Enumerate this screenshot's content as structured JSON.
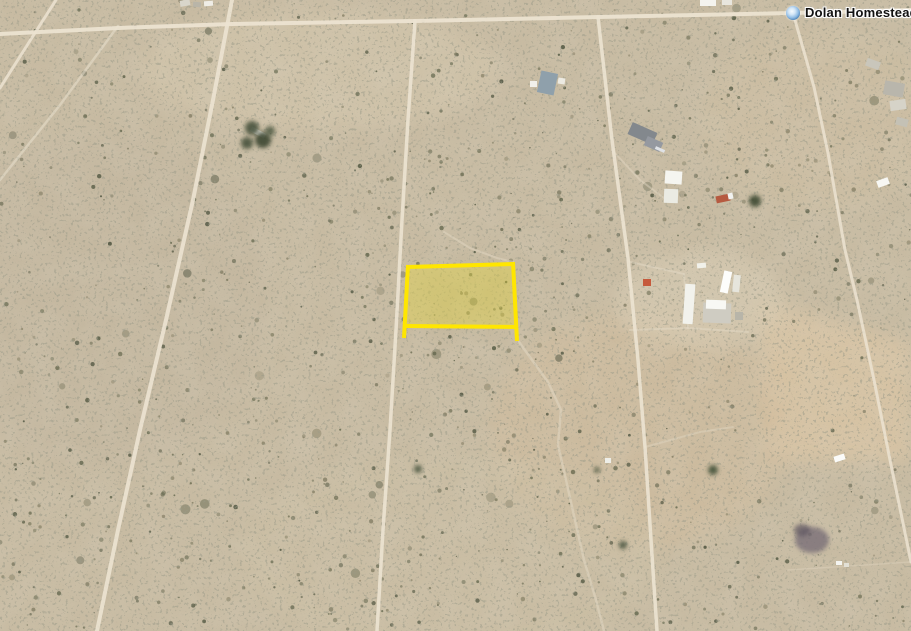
{
  "map": {
    "view": {
      "width": 911,
      "height": 631
    },
    "placemark": {
      "label": "Dolan Homestead",
      "x": 793,
      "y": 13
    },
    "colors": {
      "sand_base": "#c9bca3",
      "road": "#ece3d1",
      "trail": "#e4dac6",
      "parcel_stroke": "#ffe600",
      "parcel_fill": "#efdc35"
    },
    "parcel": {
      "name": "highlighted-parcel",
      "fill_polygon": [
        [
          408,
          266
        ],
        [
          514,
          263
        ],
        [
          517,
          326
        ],
        [
          406,
          325
        ]
      ],
      "fill_opacity": 0.35,
      "stroke_width": 4,
      "edges": [
        {
          "name": "parcel-edge-left",
          "points": [
            [
              408,
              265
            ],
            [
              404,
              338
            ]
          ]
        },
        {
          "name": "parcel-edge-right",
          "points": [
            [
              513,
              262
            ],
            [
              517,
              341
            ]
          ]
        },
        {
          "name": "parcel-edge-top",
          "points": [
            [
              407,
              267
            ],
            [
              514,
              264
            ]
          ]
        },
        {
          "name": "parcel-edge-bottom",
          "points": [
            [
              405,
              326
            ],
            [
              517,
              327
            ]
          ]
        }
      ]
    },
    "roads": [
      {
        "name": "top-road",
        "width": 4,
        "opacity": 0.95,
        "points": [
          [
            0,
            34
          ],
          [
            118,
            28
          ],
          [
            232,
            24
          ],
          [
            415,
            21
          ],
          [
            598,
            17
          ],
          [
            793,
            13
          ],
          [
            911,
            10
          ]
        ]
      },
      {
        "name": "long-diagonal-road",
        "width": 4,
        "opacity": 0.9,
        "points": [
          [
            232,
            0
          ],
          [
            213,
            100
          ],
          [
            193,
            200
          ],
          [
            166,
            320
          ],
          [
            140,
            430
          ],
          [
            118,
            530
          ],
          [
            97,
            631
          ]
        ]
      },
      {
        "name": "left-short-road",
        "width": 3,
        "opacity": 0.85,
        "points": [
          [
            56,
            0
          ],
          [
            40,
            25
          ],
          [
            0,
            88
          ]
        ]
      },
      {
        "name": "left-faint-trail",
        "width": 2.5,
        "opacity": 0.5,
        "points": [
          [
            118,
            26
          ],
          [
            60,
            105
          ],
          [
            0,
            180
          ]
        ]
      },
      {
        "name": "center-road",
        "width": 3.5,
        "opacity": 0.9,
        "points": [
          [
            415,
            21
          ],
          [
            408,
            120
          ],
          [
            402,
            220
          ],
          [
            396,
            330
          ],
          [
            390,
            430
          ],
          [
            383,
            530
          ],
          [
            377,
            631
          ]
        ]
      },
      {
        "name": "right-center-road",
        "width": 3.5,
        "opacity": 0.9,
        "points": [
          [
            598,
            17
          ],
          [
            612,
            140
          ],
          [
            628,
            258
          ],
          [
            638,
            360
          ],
          [
            645,
            447
          ],
          [
            651,
            540
          ],
          [
            657,
            631
          ]
        ]
      },
      {
        "name": "marker-road",
        "width": 3,
        "opacity": 0.85,
        "points": [
          [
            793,
            13
          ],
          [
            814,
            87
          ],
          [
            828,
            153
          ],
          [
            845,
            250
          ],
          [
            857,
            300
          ],
          [
            874,
            380
          ],
          [
            890,
            460
          ],
          [
            911,
            562
          ]
        ]
      }
    ],
    "trails": [
      {
        "name": "wash-below-parcel",
        "width": 2.5,
        "opacity": 0.5,
        "points": [
          [
            519,
            342
          ],
          [
            548,
            382
          ],
          [
            561,
            410
          ],
          [
            558,
            445
          ],
          [
            566,
            480
          ],
          [
            575,
            520
          ],
          [
            584,
            560
          ],
          [
            596,
            600
          ],
          [
            604,
            631
          ]
        ]
      },
      {
        "name": "wash-above-parcel",
        "width": 2,
        "opacity": 0.45,
        "points": [
          [
            444,
            232
          ],
          [
            470,
            248
          ],
          [
            497,
            258
          ],
          [
            513,
            262
          ]
        ]
      },
      {
        "name": "compound-drive-1",
        "width": 2,
        "opacity": 0.5,
        "points": [
          [
            630,
            262
          ],
          [
            684,
            274
          ]
        ]
      },
      {
        "name": "compound-drive-2",
        "width": 2,
        "opacity": 0.5,
        "points": [
          [
            684,
            274
          ],
          [
            688,
            328
          ]
        ]
      },
      {
        "name": "compound-drive-3",
        "width": 2,
        "opacity": 0.5,
        "points": [
          [
            630,
            330
          ],
          [
            688,
            328
          ],
          [
            748,
            332
          ]
        ]
      },
      {
        "name": "farm-drive",
        "width": 2,
        "opacity": 0.45,
        "points": [
          [
            612,
            150
          ],
          [
            640,
            180
          ],
          [
            664,
            198
          ]
        ]
      },
      {
        "name": "fence-line-right",
        "width": 1.5,
        "opacity": 0.35,
        "points": [
          [
            788,
            570
          ],
          [
            911,
            562
          ]
        ]
      },
      {
        "name": "field-track",
        "width": 2,
        "opacity": 0.4,
        "points": [
          [
            645,
            447
          ],
          [
            700,
            432
          ],
          [
            733,
            427
          ]
        ]
      }
    ],
    "terrain": {
      "bush_seed": 20240711,
      "bush_count": 1700,
      "bush_base_density": 0.42,
      "bush_palette": [
        "#6e6e54",
        "#61654c",
        "#555a44",
        "#7a7860",
        "#868066",
        "#4c523e"
      ],
      "density_zones": [
        {
          "x1": 370,
          "y1": 150,
          "x2": 580,
          "y2": 370,
          "d": 0.85
        },
        {
          "x1": 600,
          "y1": 70,
          "x2": 911,
          "y2": 270,
          "d": 0.75
        },
        {
          "x1": 0,
          "y1": 360,
          "x2": 280,
          "y2": 631,
          "d": 0.65
        },
        {
          "x1": 290,
          "y1": 420,
          "x2": 600,
          "y2": 631,
          "d": 0.7
        },
        {
          "x1": 230,
          "y1": 28,
          "x2": 420,
          "y2": 130,
          "d": 0.18
        },
        {
          "x1": 755,
          "y1": 300,
          "x2": 911,
          "y2": 462,
          "d": 0.12
        },
        {
          "x1": 620,
          "y1": 250,
          "x2": 770,
          "y2": 345,
          "d": 0.25
        }
      ],
      "patches": [
        {
          "type": "ellipse",
          "cx": 320,
          "cy": 70,
          "rx": 180,
          "ry": 60,
          "color": "#d7c9ae",
          "opacity": 0.55
        },
        {
          "type": "ellipse",
          "cx": 100,
          "cy": 300,
          "rx": 170,
          "ry": 170,
          "color": "#c4b7a0",
          "opacity": 0.5
        },
        {
          "type": "ellipse",
          "cx": 820,
          "cy": 120,
          "rx": 120,
          "ry": 90,
          "color": "#d3c2a4",
          "opacity": 0.4
        },
        {
          "type": "polygon",
          "points": [
            [
              755,
              298
            ],
            [
              911,
              342
            ],
            [
              911,
              462
            ],
            [
              768,
              462
            ]
          ],
          "color": "#dcc6a5",
          "opacity": 0.8
        },
        {
          "type": "ellipse",
          "cx": 640,
          "cy": 430,
          "rx": 150,
          "ry": 120,
          "color": "#d5bd9b",
          "opacity": 0.45
        },
        {
          "type": "ellipse",
          "cx": 700,
          "cy": 300,
          "rx": 85,
          "ry": 50,
          "color": "#dbcfb6",
          "opacity": 0.6
        },
        {
          "type": "ellipse",
          "cx": 450,
          "cy": 555,
          "rx": 210,
          "ry": 100,
          "color": "#cfc2a6",
          "opacity": 0.45
        },
        {
          "type": "ellipse",
          "cx": 462,
          "cy": 295,
          "rx": 62,
          "ry": 36,
          "color": "#a9a37e",
          "opacity": 0.22
        }
      ],
      "ground_marks": [
        {
          "cx": 812,
          "cy": 540,
          "rx": 17,
          "ry": 13,
          "color": "#756a74",
          "opacity": 0.75
        },
        {
          "cx": 802,
          "cy": 530,
          "rx": 8,
          "ry": 6,
          "color": "#5d5560",
          "opacity": 0.7
        }
      ]
    },
    "buildings": [
      {
        "name": "top-edge-building-1",
        "x": 700,
        "y": 0,
        "w": 16,
        "h": 6,
        "rot": 0,
        "color": "#f4f3ee"
      },
      {
        "name": "top-edge-building-2",
        "x": 722,
        "y": 0,
        "w": 10,
        "h": 5,
        "rot": 0,
        "color": "#e8e6de"
      },
      {
        "name": "debris-top-left-1",
        "x": 180,
        "y": 0,
        "w": 10,
        "h": 6,
        "rot": -10,
        "color": "#d9d6cb"
      },
      {
        "name": "debris-top-left-2",
        "x": 193,
        "y": 2,
        "w": 8,
        "h": 5,
        "rot": 5,
        "color": "#b9b5a8"
      },
      {
        "name": "debris-top-left-3",
        "x": 204,
        "y": 1,
        "w": 9,
        "h": 5,
        "rot": -5,
        "color": "#efede6"
      },
      {
        "name": "farm-roof",
        "x": 539,
        "y": 72,
        "w": 17,
        "h": 22,
        "rot": 12,
        "color": "#8fa0ab"
      },
      {
        "name": "farm-shed-left",
        "x": 530,
        "y": 81,
        "w": 7,
        "h": 6,
        "rot": 0,
        "color": "#f1f0ea"
      },
      {
        "name": "farm-shed-right",
        "x": 558,
        "y": 78,
        "w": 7,
        "h": 6,
        "rot": 8,
        "color": "#eceae2"
      },
      {
        "name": "homestead-roof-streak",
        "x": 250,
        "y": 130,
        "w": 16,
        "h": 5,
        "rot": 28,
        "color": "#eceae2"
      },
      {
        "name": "gray-house-main",
        "x": 629,
        "y": 127,
        "w": 27,
        "h": 13,
        "rot": 24,
        "color": "#83888d"
      },
      {
        "name": "gray-house-wing",
        "x": 645,
        "y": 139,
        "w": 17,
        "h": 10,
        "rot": 24,
        "color": "#9599a0"
      },
      {
        "name": "gray-house-edge",
        "x": 655,
        "y": 148,
        "w": 10,
        "h": 3,
        "rot": 24,
        "color": "#dfe2e6"
      },
      {
        "name": "white-building-1",
        "x": 665,
        "y": 171,
        "w": 17,
        "h": 13,
        "rot": 4,
        "color": "#f5f5f0"
      },
      {
        "name": "white-building-2",
        "x": 664,
        "y": 189,
        "w": 14,
        "h": 14,
        "rot": 2,
        "color": "#ebebe3"
      },
      {
        "name": "red-truck",
        "x": 716,
        "y": 195,
        "w": 14,
        "h": 7,
        "rot": -12,
        "color": "#b65a40"
      },
      {
        "name": "red-truck-cab",
        "x": 728,
        "y": 193,
        "w": 5,
        "h": 6,
        "rot": -12,
        "color": "#f2f2ef"
      },
      {
        "name": "junk-pile-1",
        "x": 884,
        "y": 82,
        "w": 20,
        "h": 14,
        "rot": 10,
        "color": "#b9b6ac"
      },
      {
        "name": "junk-pile-2",
        "x": 890,
        "y": 100,
        "w": 16,
        "h": 10,
        "rot": -8,
        "color": "#d6d3c8"
      },
      {
        "name": "junk-pile-3",
        "x": 896,
        "y": 118,
        "w": 12,
        "h": 8,
        "rot": 15,
        "color": "#c4c1b5"
      },
      {
        "name": "junk-pile-4",
        "x": 866,
        "y": 60,
        "w": 14,
        "h": 8,
        "rot": 20,
        "color": "#c9c6bb"
      },
      {
        "name": "white-trailer-right",
        "x": 877,
        "y": 179,
        "w": 12,
        "h": 7,
        "rot": -20,
        "color": "#f7f7f3"
      },
      {
        "name": "compound-long-trailer",
        "x": 684,
        "y": 284,
        "w": 10,
        "h": 40,
        "rot": 4,
        "color": "#f2f2ec"
      },
      {
        "name": "compound-rv-1",
        "x": 722,
        "y": 271,
        "w": 8,
        "h": 22,
        "rot": 12,
        "color": "#fdfdfb"
      },
      {
        "name": "compound-rv-2",
        "x": 733,
        "y": 275,
        "w": 7,
        "h": 17,
        "rot": 6,
        "color": "#e6e5dc"
      },
      {
        "name": "compound-cluster",
        "x": 703,
        "y": 303,
        "w": 28,
        "h": 20,
        "rot": 2,
        "color": "#cfccc2"
      },
      {
        "name": "compound-white-roof",
        "x": 706,
        "y": 300,
        "w": 20,
        "h": 9,
        "rot": 2,
        "color": "#f8f8f4"
      },
      {
        "name": "compound-shed",
        "x": 735,
        "y": 312,
        "w": 8,
        "h": 8,
        "rot": 0,
        "color": "#b8b5a9"
      },
      {
        "name": "compound-red-item",
        "x": 643,
        "y": 279,
        "w": 8,
        "h": 7,
        "rot": 0,
        "color": "#c65a3c"
      },
      {
        "name": "compound-small-white",
        "x": 697,
        "y": 263,
        "w": 9,
        "h": 5,
        "rot": -5,
        "color": "#f1f1ea"
      },
      {
        "name": "white-car-bottom",
        "x": 834,
        "y": 455,
        "w": 11,
        "h": 6,
        "rot": -18,
        "color": "#fbfbf9"
      },
      {
        "name": "white-speck-bottom",
        "x": 605,
        "y": 458,
        "w": 6,
        "h": 5,
        "rot": 0,
        "color": "#eeeee8"
      },
      {
        "name": "white-pair-bottom-1",
        "x": 836,
        "y": 561,
        "w": 6,
        "h": 4,
        "rot": 0,
        "color": "#f4f4f0"
      },
      {
        "name": "white-pair-bottom-2",
        "x": 844,
        "y": 563,
        "w": 5,
        "h": 4,
        "rot": 0,
        "color": "#e2e0d6"
      }
    ],
    "trees": [
      {
        "name": "homestead-tree-1",
        "cx": 252,
        "cy": 128,
        "r": 7,
        "color": "#4a523c"
      },
      {
        "name": "homestead-tree-2",
        "cx": 263,
        "cy": 140,
        "r": 8,
        "color": "#3e4733"
      },
      {
        "name": "homestead-tree-3",
        "cx": 247,
        "cy": 143,
        "r": 6,
        "color": "#4a523c"
      },
      {
        "name": "homestead-tree-4",
        "cx": 270,
        "cy": 131,
        "r": 5,
        "color": "#56604a"
      },
      {
        "name": "lone-tree-right",
        "cx": 755,
        "cy": 201,
        "r": 6,
        "color": "#3c4832"
      },
      {
        "name": "bush-tree-1",
        "cx": 713,
        "cy": 470,
        "r": 5,
        "color": "#45523b"
      },
      {
        "name": "bush-tree-2",
        "cx": 623,
        "cy": 545,
        "r": 4,
        "color": "#4a5540"
      },
      {
        "name": "bush-tree-3",
        "cx": 418,
        "cy": 469,
        "r": 4,
        "color": "#4e5942"
      },
      {
        "name": "bush-tree-4",
        "cx": 597,
        "cy": 470,
        "r": 3,
        "color": "#525c44"
      }
    ]
  }
}
